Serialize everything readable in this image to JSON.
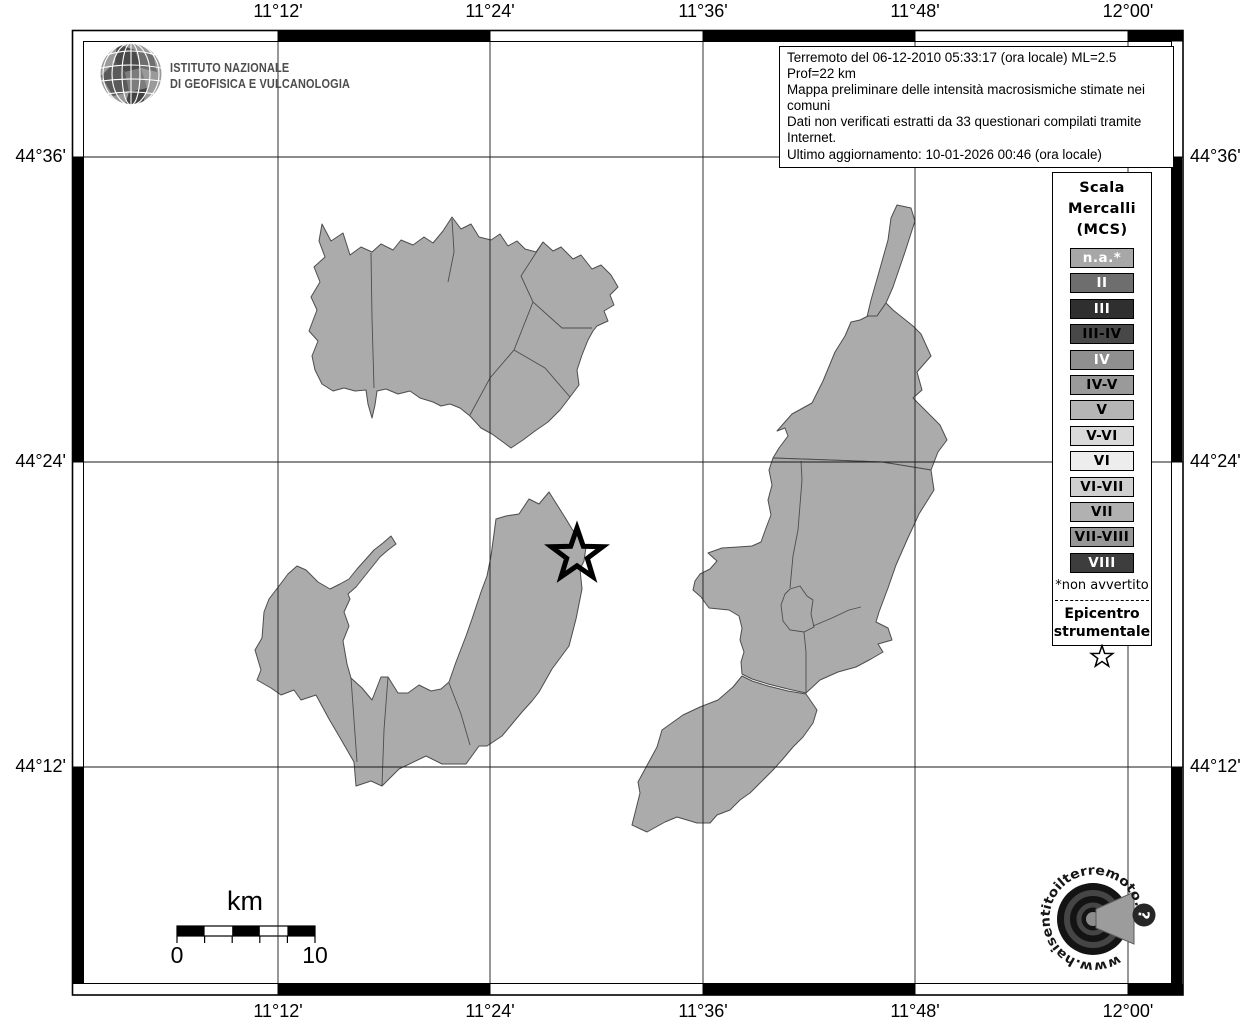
{
  "header": {
    "agency_line1": "ISTITUTO NAZIONALE",
    "agency_line2": "DI GEOFISICA E VULCANOLOGIA"
  },
  "info_box": {
    "lines": [
      "Terremoto del 06-12-2010 05:33:17 (ora locale) ML=2.5 Prof=22 km",
      "Mappa preliminare delle intensità macrosismiche stimate nei comuni",
      "Dati non verificati estratti da 33 questionari compilati tramite Internet.",
      "Ultimo aggiornamento: 10-01-2026 00:46 (ora locale)"
    ]
  },
  "axis": {
    "lon_labels": [
      "11°12'",
      "11°24'",
      "11°36'",
      "11°48'",
      "12°00'"
    ],
    "lat_labels": [
      "44°36'",
      "44°24'",
      "44°12'"
    ]
  },
  "legend": {
    "title_lines": [
      "Scala",
      "Mercalli",
      "(MCS)"
    ],
    "items": [
      {
        "label": "n.a.*",
        "bg": "#a7a7a7",
        "fg": "#ffffff"
      },
      {
        "label": "II",
        "bg": "#6e6e6e",
        "fg": "#ffffff"
      },
      {
        "label": "III",
        "bg": "#2f2f2f",
        "fg": "#ffffff"
      },
      {
        "label": "III-IV",
        "bg": "#484848",
        "fg": "#000000"
      },
      {
        "label": "IV",
        "bg": "#8f8f8f",
        "fg": "#ffffff"
      },
      {
        "label": "IV-V",
        "bg": "#9a9a9a",
        "fg": "#000000"
      },
      {
        "label": "V",
        "bg": "#b5b5b5",
        "fg": "#000000"
      },
      {
        "label": "V-VI",
        "bg": "#d9d9d9",
        "fg": "#000000"
      },
      {
        "label": "VI",
        "bg": "#ededed",
        "fg": "#000000"
      },
      {
        "label": "VI-VII",
        "bg": "#cfcfcf",
        "fg": "#000000"
      },
      {
        "label": "VII",
        "bg": "#b1b1b1",
        "fg": "#000000"
      },
      {
        "label": "VII-VIII",
        "bg": "#979797",
        "fg": "#000000"
      },
      {
        "label": "VIII",
        "bg": "#3d3d3d",
        "fg": "#ffffff"
      }
    ],
    "footnote": "*non avvertito",
    "epicenter_label_line1": "Epicentro",
    "epicenter_label_line2": "strumentale"
  },
  "scale_bar": {
    "unit": "km",
    "start": "0",
    "end": "10"
  },
  "watermark": {
    "url_text": "www.haisentitoilterremoto.it",
    "question_mark": "?"
  },
  "colors": {
    "municipality_fill": "#ababab",
    "municipality_outline": "#4d4d4d",
    "grid_line": "#1a1a1a"
  }
}
